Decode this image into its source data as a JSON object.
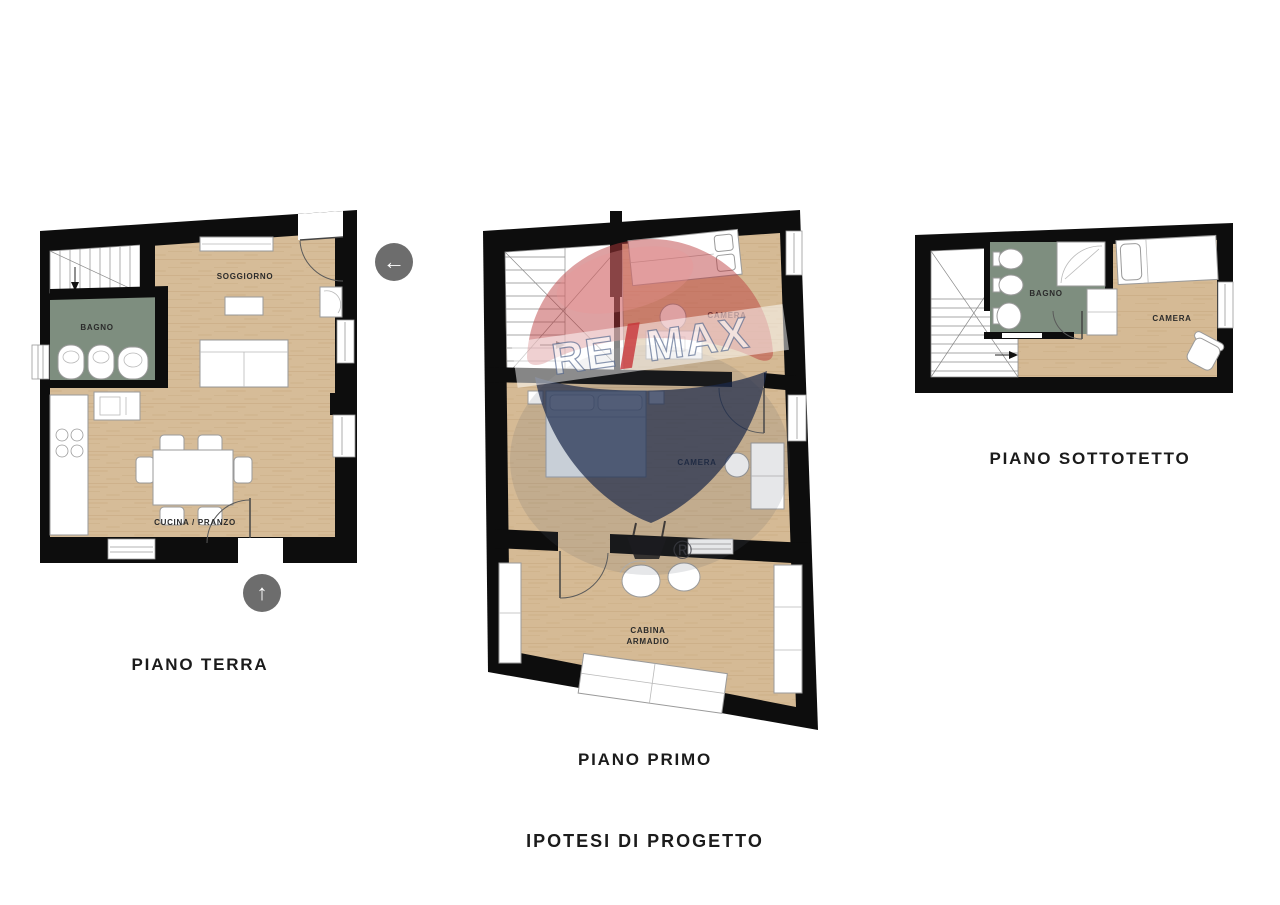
{
  "footer": {
    "title": "IPOTESI DI PROGETTO"
  },
  "icons": {
    "left_arrow": "←",
    "up_arrow": "↑"
  },
  "watermark": {
    "brand_left": "RE",
    "brand_slash": "/",
    "brand_right": "MAX",
    "registered": "®",
    "balloon_red": "#c1272d",
    "balloon_blue": "#1b3058"
  },
  "colors": {
    "wall": "#0d0d0d",
    "wood_floor": "#d6bc98",
    "bathroom_floor": "#7e8e7f",
    "icon_circle": "#6d6d6d",
    "background": "#ffffff"
  },
  "plans": [
    {
      "id": "piano-terra",
      "label": "PIANO TERRA",
      "rooms": [
        {
          "name": "SOGGIORNO"
        },
        {
          "name": "BAGNO"
        },
        {
          "name": "CUCINA / PRANZO"
        }
      ]
    },
    {
      "id": "piano-primo",
      "label": "PIANO PRIMO",
      "rooms": [
        {
          "name": "CAMERA"
        },
        {
          "name": "CAMERA"
        },
        {
          "name": "CABINA ARMADIO",
          "line1": "CABINA",
          "line2": "ARMADIO"
        }
      ]
    },
    {
      "id": "piano-sottotetto",
      "label": "PIANO SOTTOTETTO",
      "rooms": [
        {
          "name": "BAGNO"
        },
        {
          "name": "CAMERA"
        }
      ]
    }
  ]
}
